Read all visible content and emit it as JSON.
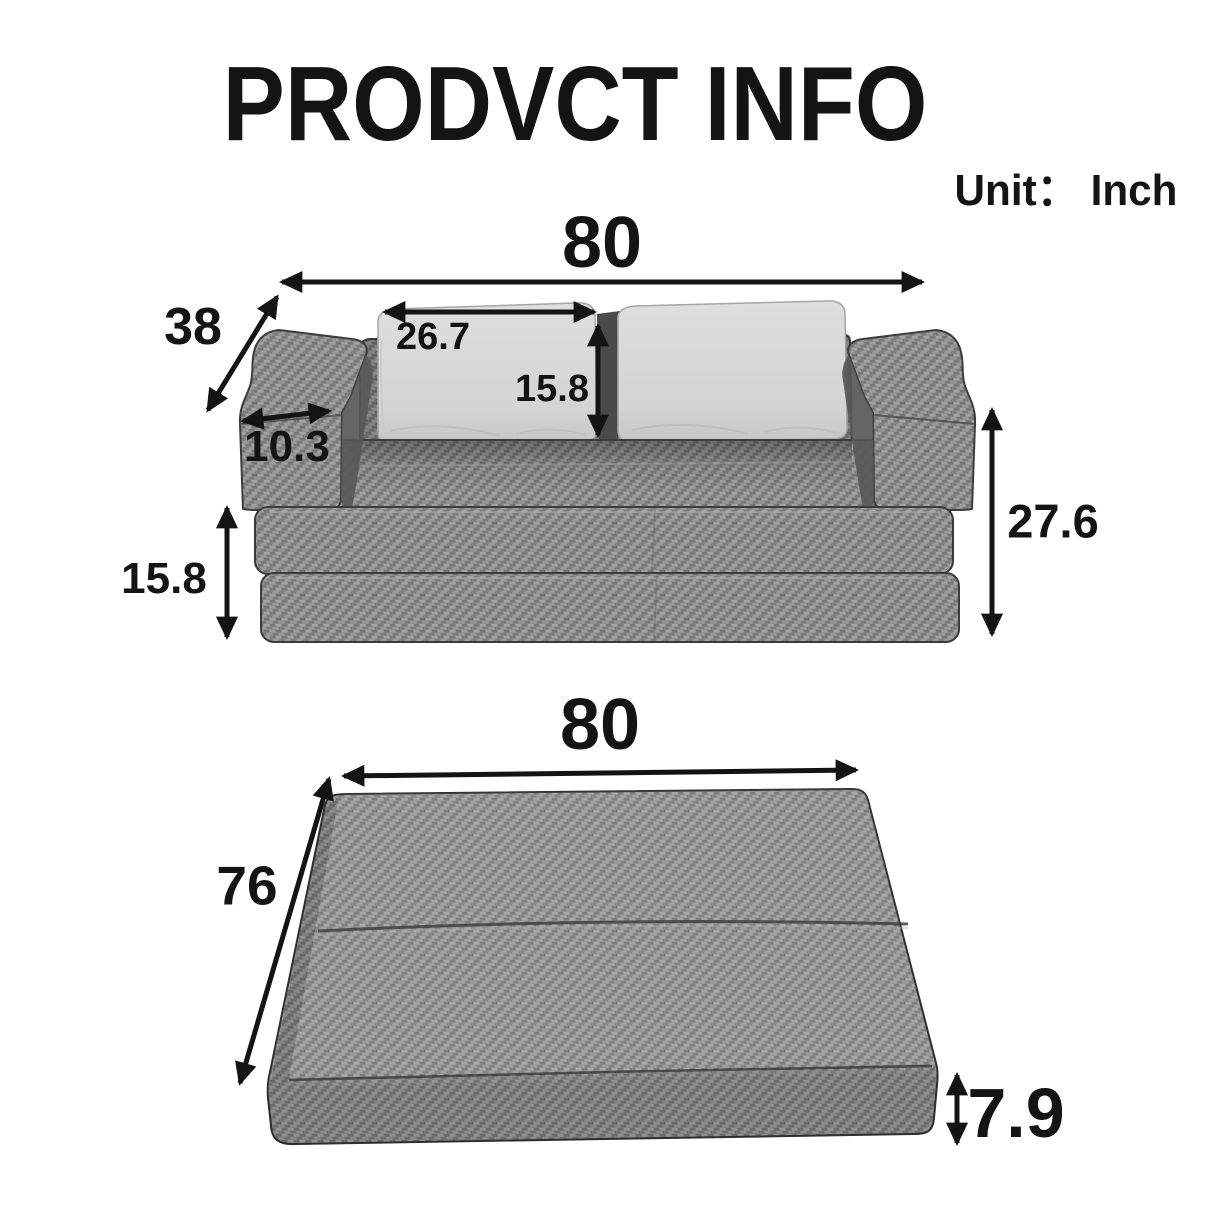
{
  "page": {
    "title": "PRODVCT INFO",
    "unit": "Unit： Inch"
  },
  "sofa_view": {
    "description": "folded sofa bed front view with two pillows",
    "dims": {
      "width": "80",
      "depth": "38",
      "pillow_width": "26.7",
      "pillow_height": "15.8",
      "armrest_width": "10.3",
      "base_stack_height": "15.8",
      "total_height": "27.6"
    }
  },
  "mattress_view": {
    "description": "unfolded flat mattress perspective view",
    "dims": {
      "width": "80",
      "depth": "76",
      "thickness": "7.9"
    }
  },
  "colors": {
    "fabric_gray": "#8e8e8e",
    "fabric_dark": "#5a5a5a",
    "pillow_gray": "#d9d9d9",
    "dimension_black": "#141414",
    "background": "#ffffff"
  }
}
